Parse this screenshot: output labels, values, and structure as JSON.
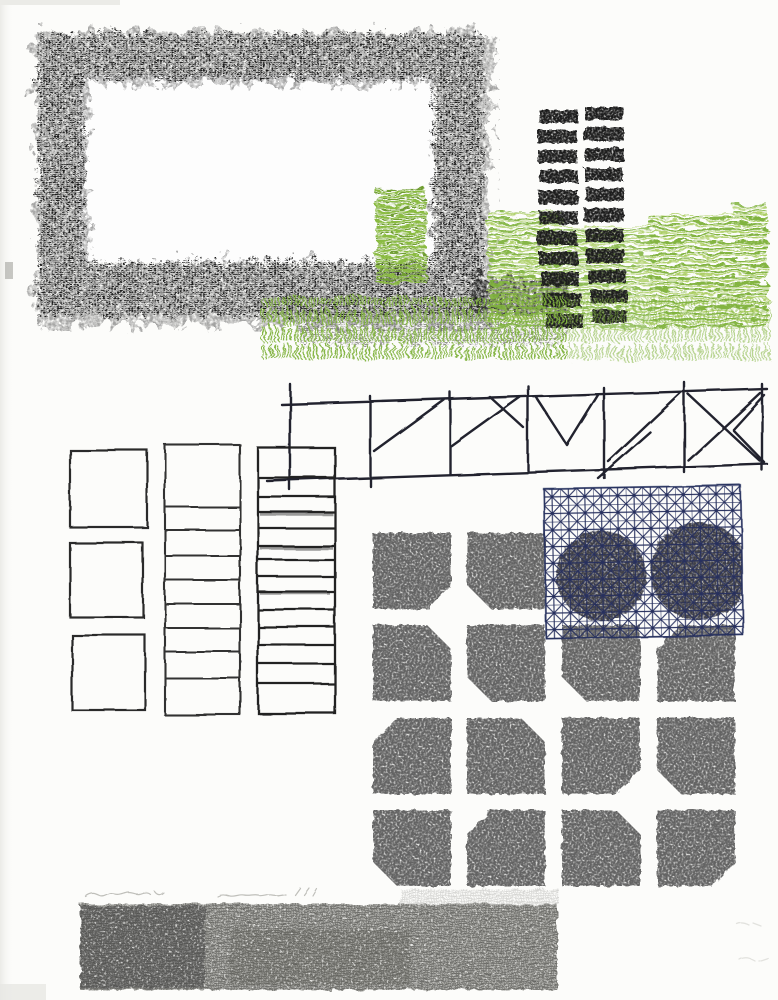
{
  "artwork": {
    "title_note": "Abstract architectural print (lithograph/serigraph style collage)",
    "background": "#fcfcfa",
    "paper_white": "#fdfdfd",
    "colors": {
      "charcoal": "#1a1a1a",
      "charcoal_halo": "#5a5a5a",
      "ink": "#20242f",
      "navy": "#27305e",
      "green": "#7fb23c",
      "green_light": "#a9cd60",
      "green_tower": "#8abb42",
      "tile_gray": "#636363",
      "circle_gray": "#3f3f46",
      "strip_gray": "#9a9a95",
      "strip_dark": "#3f3f3f",
      "pencil": "#bfbfba",
      "pencil_faint": "#e2e2de"
    },
    "elements": {
      "charcoal_frame": "large rough black rectangular frame, top left",
      "green_tower": "small striped green tower inside frame right side",
      "black_towers": "two columns of stacked black bars (high-rise motif), top right",
      "green_cityscape": "band of horizontal green strokes behind towers",
      "grass_band": "green grass strokes with black spatter under frame",
      "truss": "hand-drawn horizontal truss / scaffold with diagonal braces",
      "outlined_squares": "column of three empty squares, left middle",
      "divided_column_1": "tall outlined column with 9 horizontal rows",
      "divided_column_2": "tall outlined column with 14 dense rows",
      "tile_grid": "4x4 grid of gray chamfered-corner tiles, lower right",
      "lattice_square": "navy triangulated lattice square over two dark discs",
      "woven_strip": "gray woven-texture strip across bottom",
      "inscription_bottom_left": "(illegible pencil handwriting)",
      "inscription_bottom_right": "(faint pencil marks)"
    },
    "counts": {
      "tower_columns": 2,
      "bars_per_column": 11,
      "truss_panels": 7,
      "outlined_squares": 3,
      "column1_rows": 9,
      "column2_rows": 14,
      "tile_rows": 4,
      "tile_cols": 4
    },
    "tile_chamfers": [
      [
        "BR",
        "BL",
        "covered-by-lattice",
        "covered-by-lattice"
      ],
      [
        "TR",
        "BL",
        "BL",
        "TL"
      ],
      [
        "TL",
        "TR",
        "BR",
        "BL"
      ],
      [
        "BL",
        "TL",
        "TR",
        "BR"
      ]
    ]
  }
}
